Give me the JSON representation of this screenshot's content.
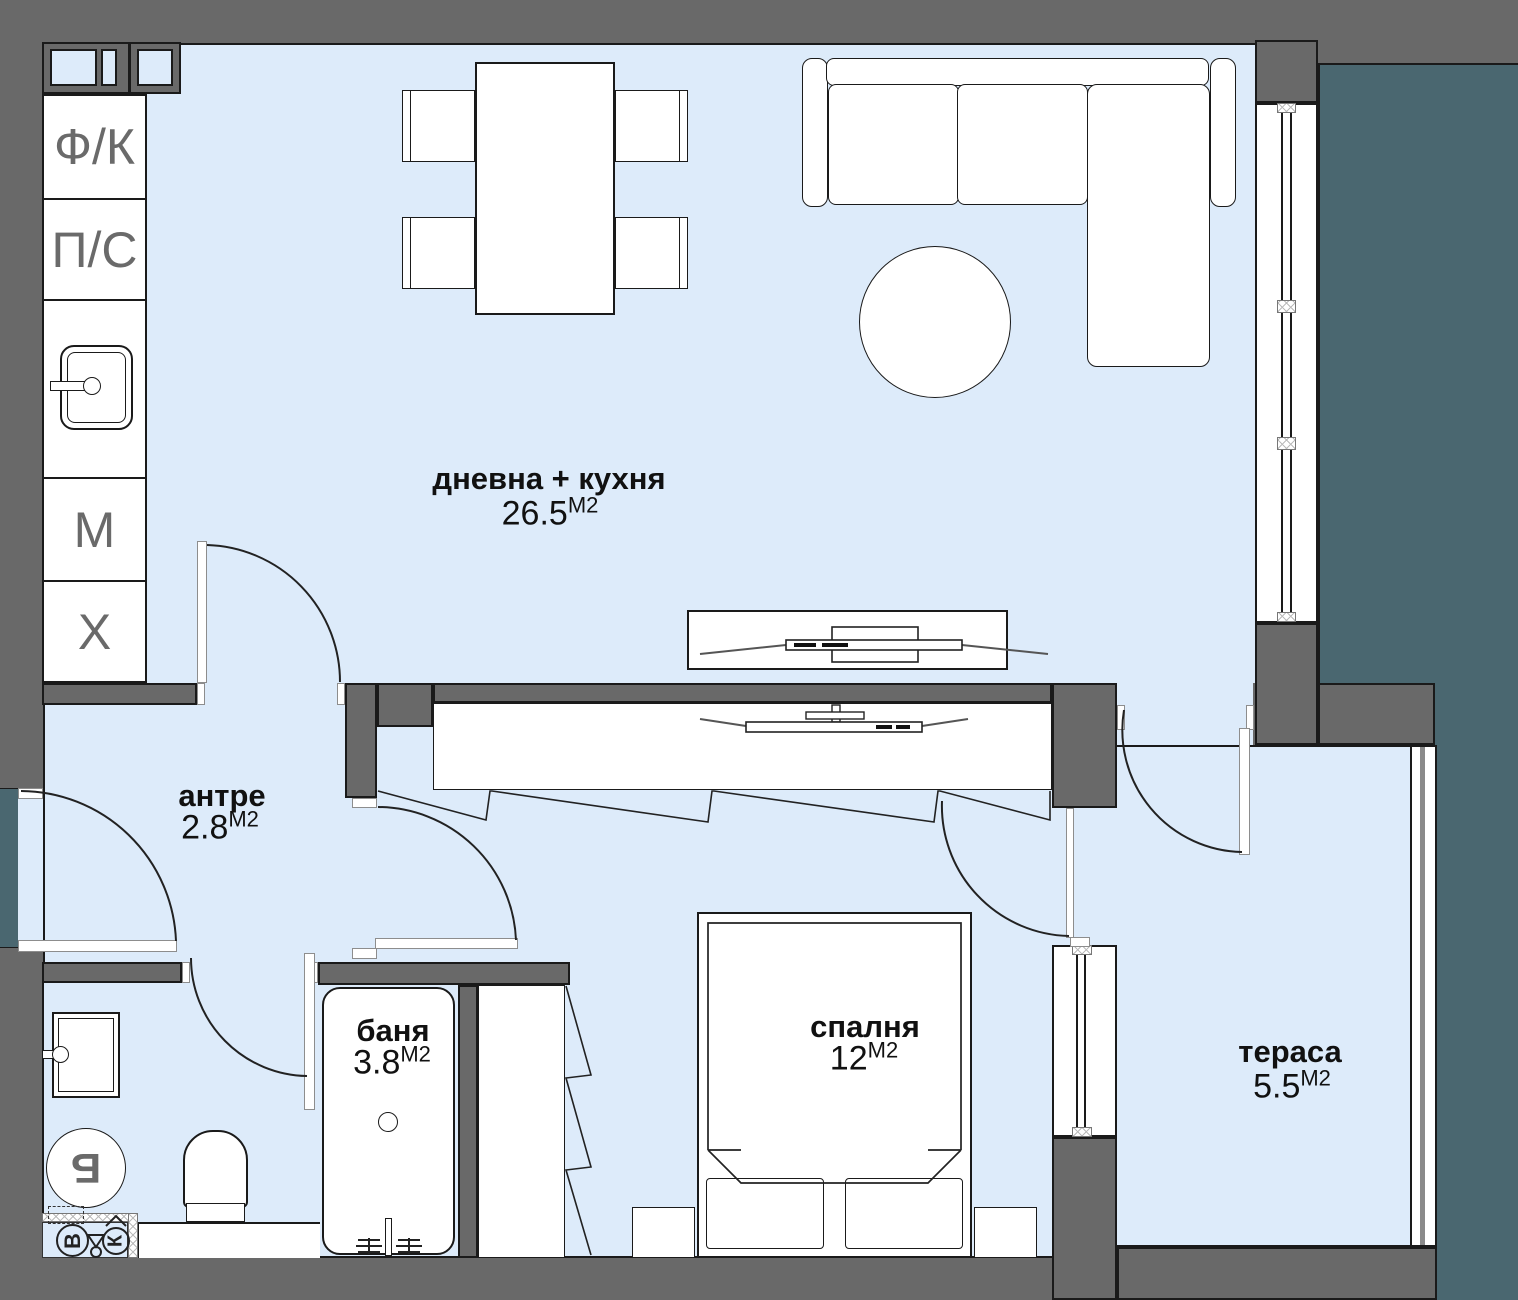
{
  "title": "Апартамент — разпределение (floor plan)",
  "units": {
    "m2": "М2"
  },
  "rooms": {
    "living": {
      "name": "дневна + кухня",
      "area": "26.5"
    },
    "entry": {
      "name": "антре",
      "area": "2.8"
    },
    "bath": {
      "name": "баня",
      "area": "3.8"
    },
    "bedroom": {
      "name": "спалня",
      "area": "12"
    },
    "terrace": {
      "name": "тераса",
      "area": "5.5"
    }
  },
  "kitchen": {
    "cells": [
      {
        "label": "Ф/К"
      },
      {
        "label": "П/С"
      },
      {
        "label": ""
      },
      {
        "label": "М"
      },
      {
        "label": "Х"
      }
    ]
  },
  "utility": {
    "boiler": "Б",
    "water": "В",
    "sewer": "К"
  },
  "colors": {
    "wall": "#696969",
    "floor": "#ddebfa",
    "exterior": "#4a6770",
    "line": "#1a1a1a",
    "furniture": "#ffffff"
  }
}
